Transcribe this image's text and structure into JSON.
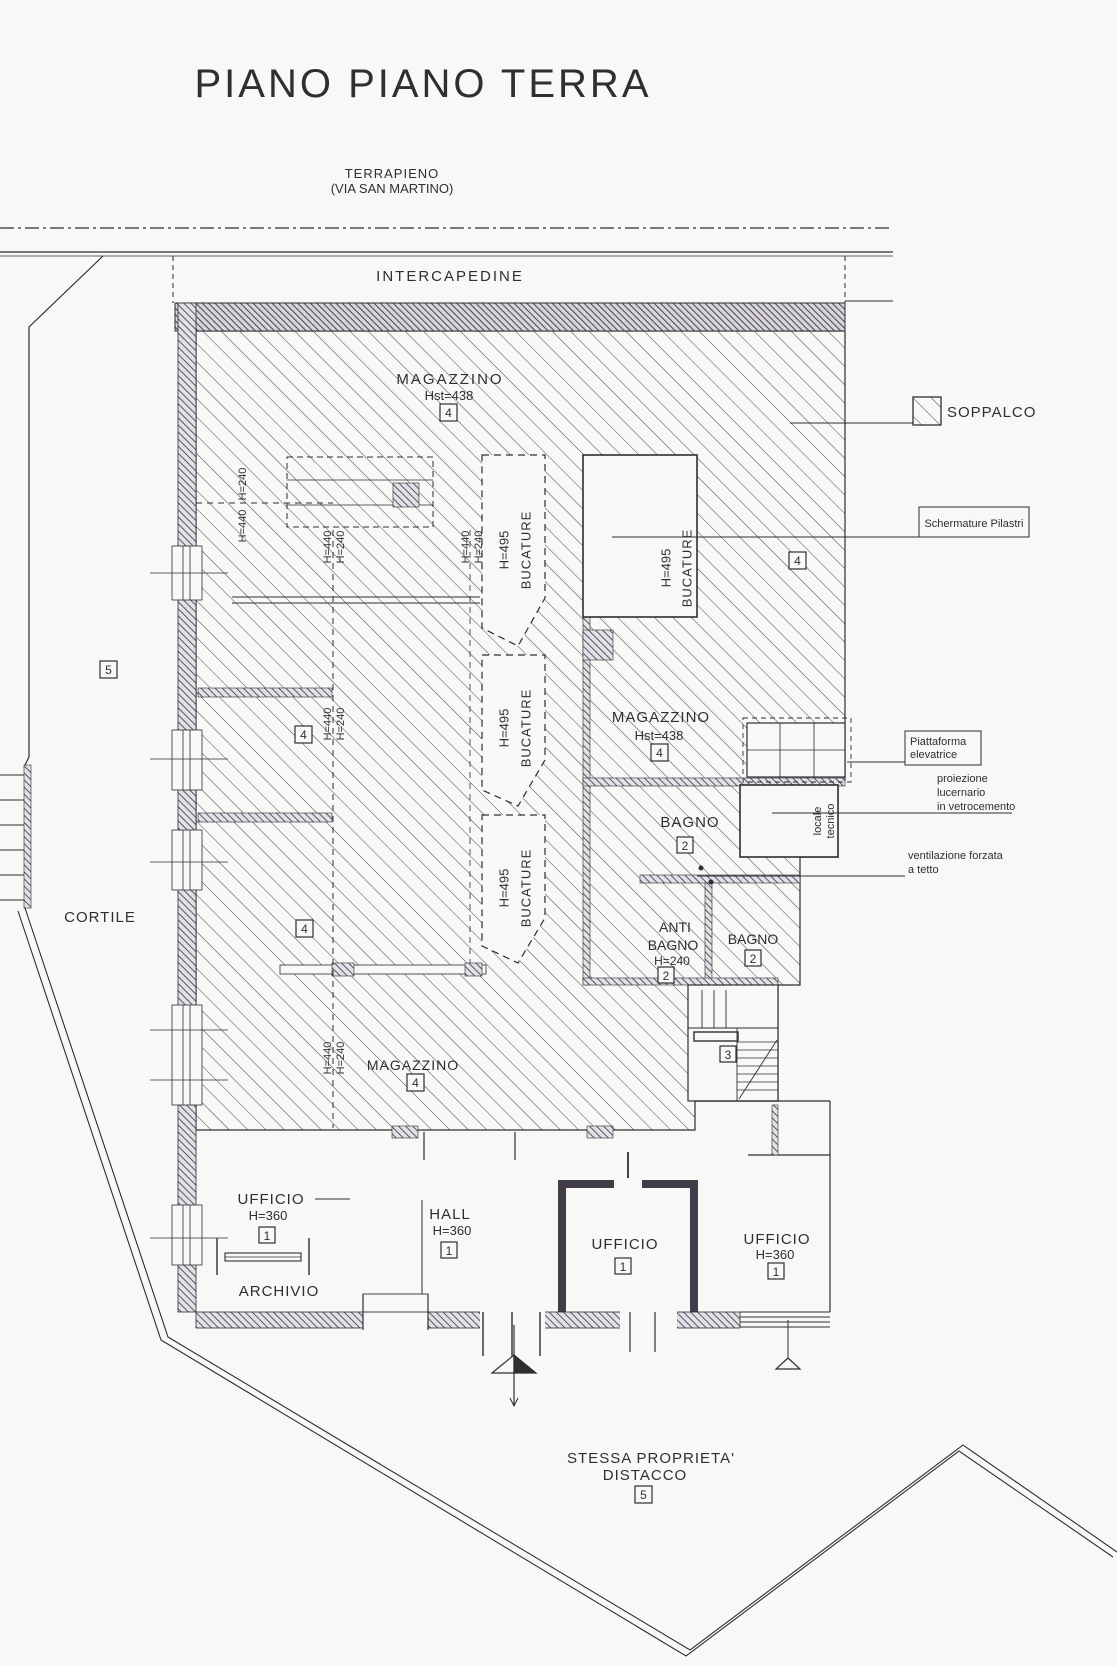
{
  "title": "PIANO PIANO TERRA",
  "site": {
    "terrapieno1": "TERRAPIENO",
    "terrapieno2": "(VIA SAN MARTINO)",
    "intercapedine": "INTERCAPEDINE",
    "cortile": "CORTILE",
    "distacco1": "STESSA PROPRIETA'",
    "distacco2": "DISTACCO"
  },
  "refs": {
    "r1": "1",
    "r2": "2",
    "r3": "3",
    "r4": "4",
    "r5": "5"
  },
  "heights": {
    "h440": "H=440",
    "h240": "H=240",
    "h495": "H=495",
    "h360": "H=360",
    "hst438": "Hst=438",
    "bucature": "BUCATURE"
  },
  "rooms": {
    "magazzino": "MAGAZZINO",
    "bagno": "BAGNO",
    "anti1": "ANTI",
    "anti2": "BAGNO",
    "locale1": "locale",
    "locale2": "tecnico",
    "ufficio": "UFFICIO",
    "archivio": "ARCHIVIO",
    "hall": "HALL"
  },
  "legend": {
    "soppalco": "SOPPALCO",
    "schermature": "Schermature Pilastri",
    "piattaforma1": "Piattaforma",
    "piattaforma2": "elevatrice",
    "proiezione1": "proiezione",
    "proiezione2": "lucernario",
    "proiezione3": "in vetrocemento",
    "ventilazione1": "ventilazione forzata",
    "ventilazione2": "a tetto"
  },
  "colors": {
    "ink": "#2f2e33",
    "wall": "#5a5464",
    "paper": "#f8f8f6"
  }
}
